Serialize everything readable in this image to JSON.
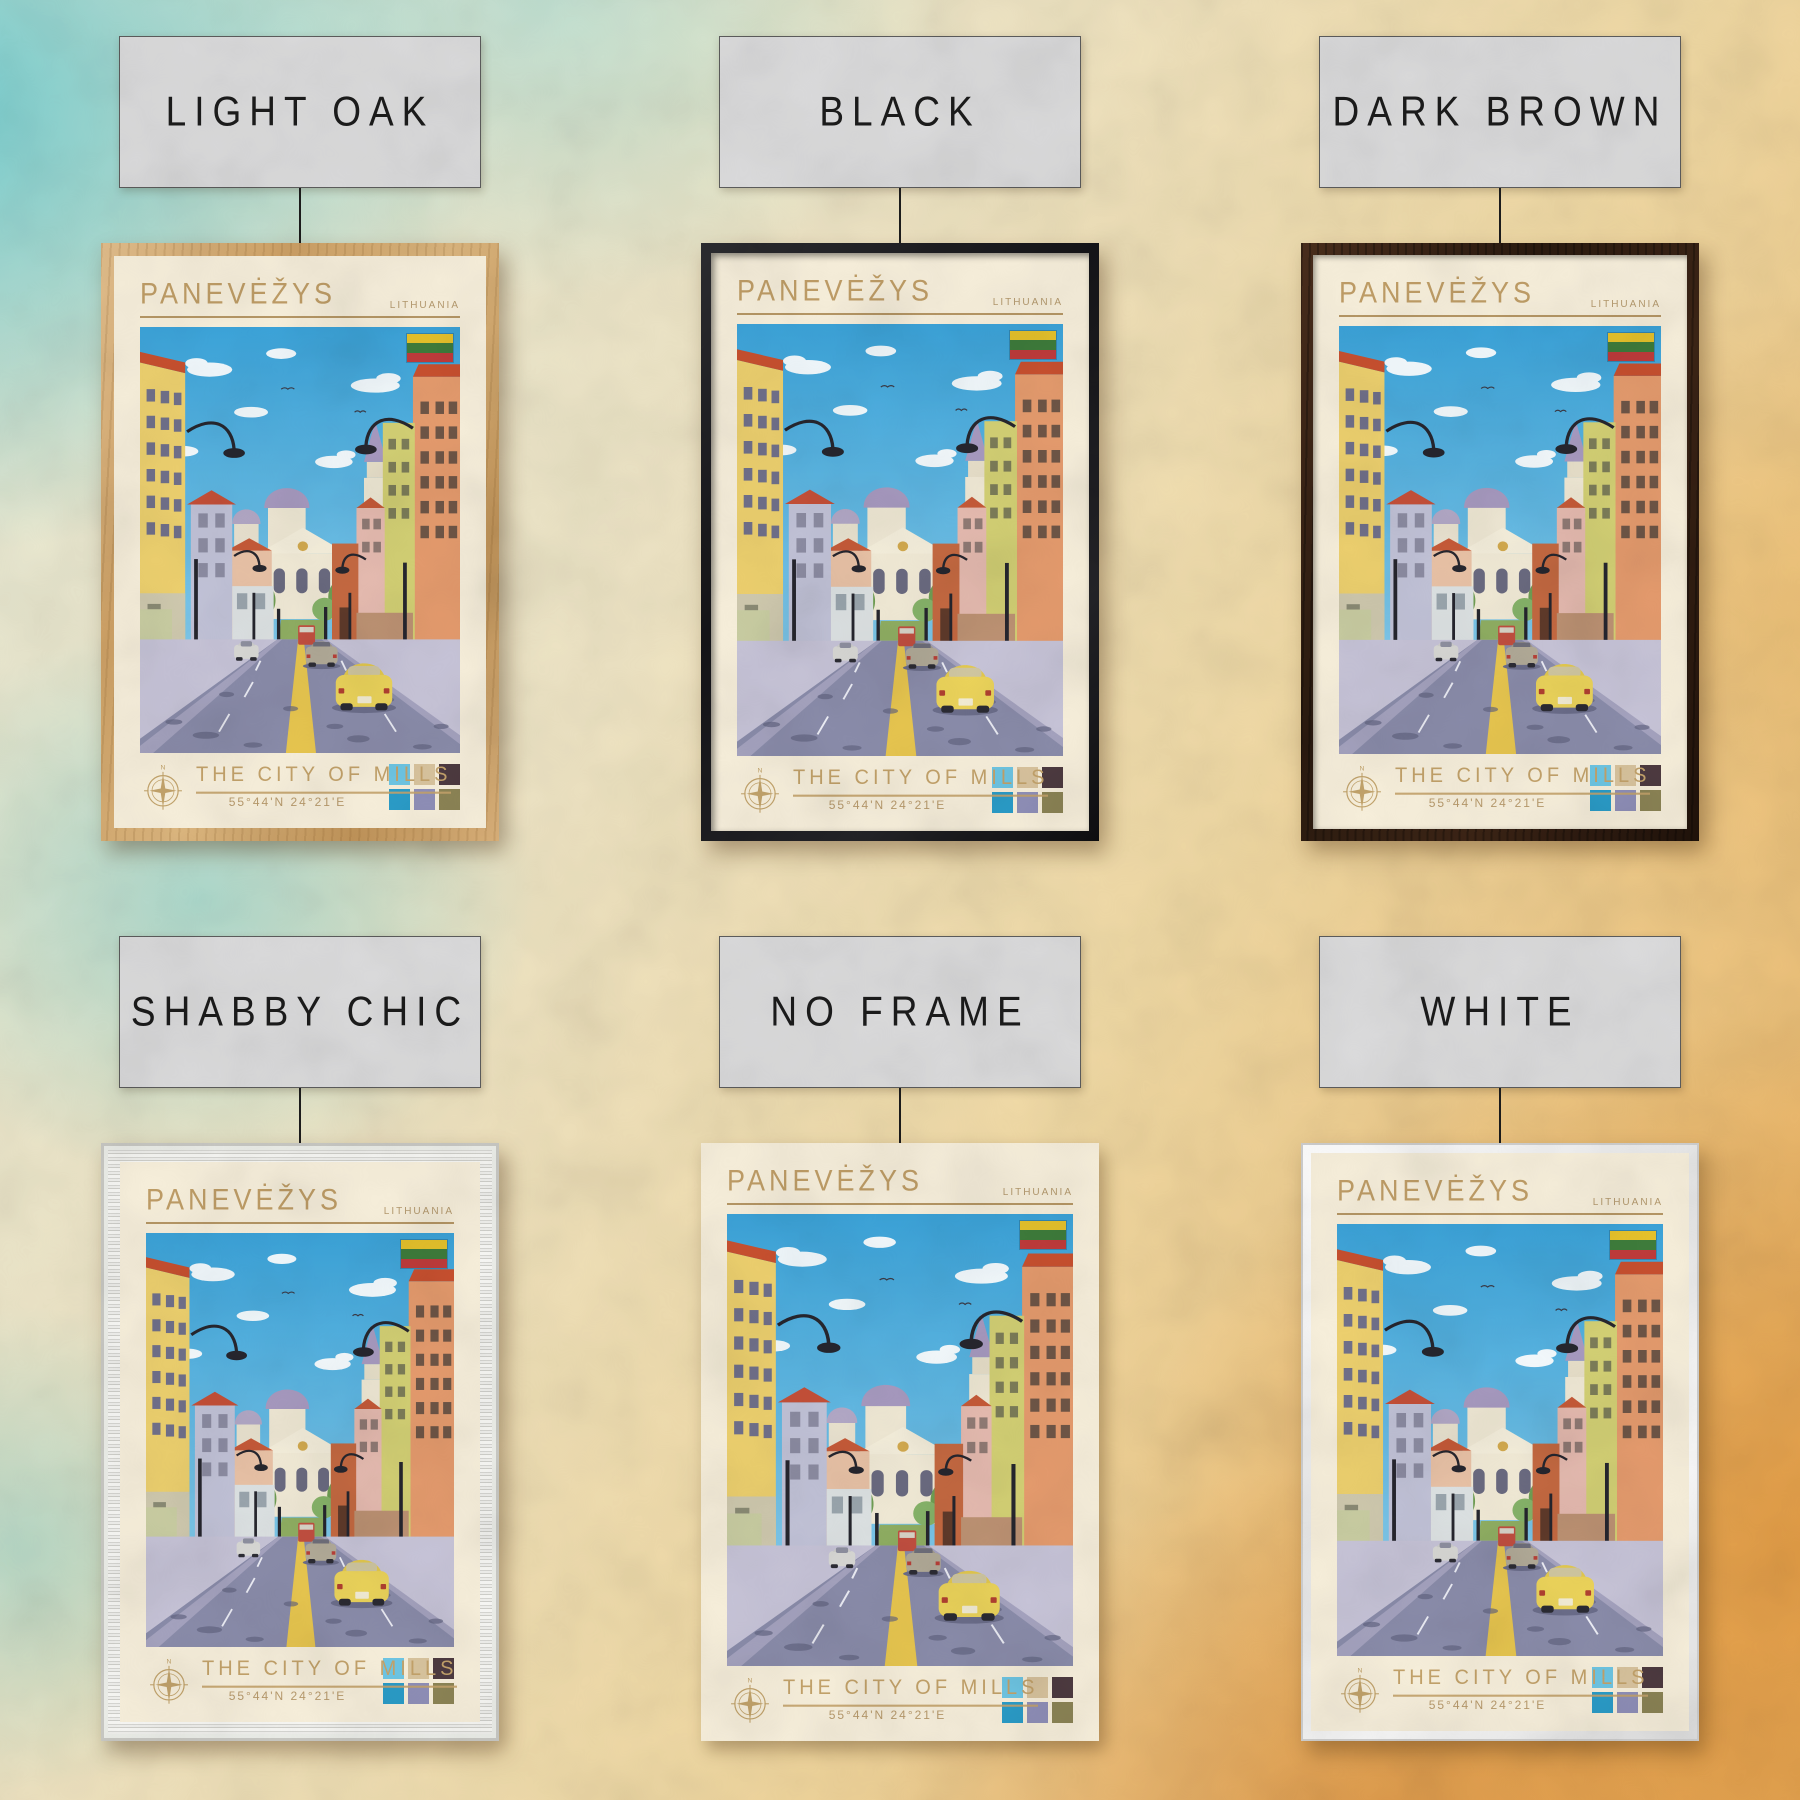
{
  "poster": {
    "title": "PANEVĖŽYS",
    "country": "LITHUANIA",
    "subtitle": "THE CITY OF MILLS",
    "coordinates": "55°44'N 24°21'E",
    "compass_n": "N",
    "flag_colors": [
      "#e6c22b",
      "#3e7c3b",
      "#c03b3b"
    ],
    "swatches": [
      "#6ec6e4",
      "#d9c49e",
      "#4d3a40",
      "#2a9cc8",
      "#8f8fb8",
      "#8c8455"
    ],
    "colors": {
      "paper": "#f7efdb",
      "accent_tan": "#c3a26a",
      "sky": "#3ba3d9",
      "road": "#8a8caa",
      "taxi_yellow": "#ebd35a"
    }
  },
  "frames": [
    {
      "label": "LIGHT OAK",
      "style": "light-oak",
      "color": "#d2a86f"
    },
    {
      "label": "BLACK",
      "style": "black",
      "color": "#1b1b1e"
    },
    {
      "label": "DARK BROWN",
      "style": "dark-brown",
      "color": "#2e1c11"
    },
    {
      "label": "SHABBY CHIC",
      "style": "shabby-chic",
      "color": "#e6e6e3"
    },
    {
      "label": "NO FRAME",
      "style": "no-frame",
      "color": ""
    },
    {
      "label": "WHITE",
      "style": "white",
      "color": "#f4f4f4"
    }
  ],
  "background": {
    "teal": "#6ec9cc",
    "cream": "#ece2c2",
    "orange": "#e2a152"
  }
}
